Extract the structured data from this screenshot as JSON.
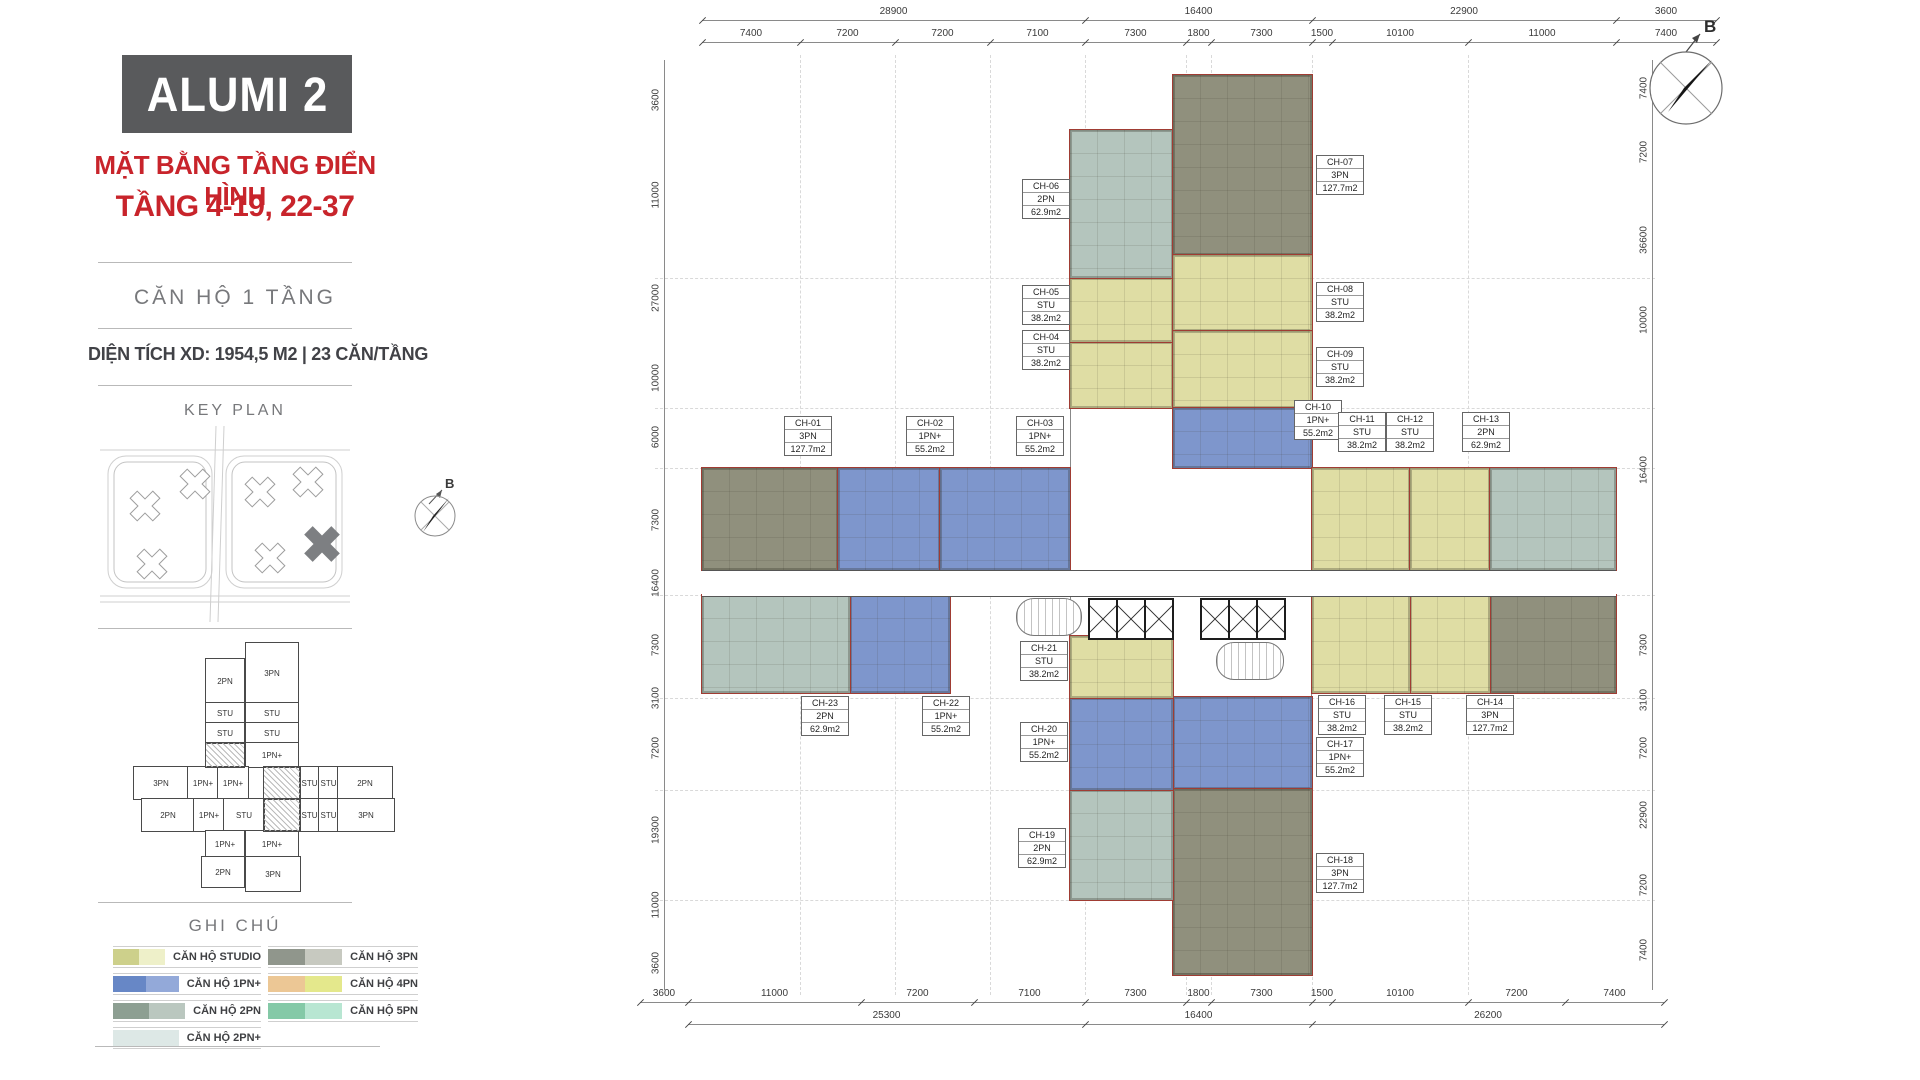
{
  "colors": {
    "accent_red": "#c8242b",
    "header_bg": "#595a5c",
    "unit_studio": "#dfdda4",
    "unit_1pn_plus": "#7e96cc",
    "unit_2pn": "#b4c5bd",
    "unit_3pn": "#90907d",
    "boundary_red": "#a03c33"
  },
  "sidebar": {
    "title": "ALUMI 2",
    "subtitle_line1": "MẶT BẰNG TẦNG ĐIỂN HÌNH",
    "subtitle_line2": "TẦNG 4-19, 22-37",
    "section_label": "CĂN HỘ 1 TẦNG",
    "stats_line": "DIỆN TÍCH XD: 1954,5 M2  |  23 CĂN/TẦNG",
    "key_plan_title": "KEY PLAN",
    "legend_title": "GHI CHÚ",
    "legend_left": [
      {
        "label": "CĂN HỘ STUDIO",
        "c1": "#cdd08b",
        "c2": "#eef0c9"
      },
      {
        "label": "CĂN HỘ 1PN+",
        "c1": "#6787c6",
        "c2": "#93a9d9"
      },
      {
        "label": "CĂN HỘ 2PN",
        "c1": "#8d9f92",
        "c2": "#bac7bf"
      },
      {
        "label": "CĂN HỘ 2PN+",
        "c1": "#dde8e6",
        "c2": "#dde8e6"
      }
    ],
    "legend_right": [
      {
        "label": "CĂN HỘ 3PN",
        "c1": "#90968c",
        "c2": "#c7c9c0"
      },
      {
        "label": "CĂN HỘ 4PN",
        "c1": "#ecc795",
        "c2": "#e4e88c"
      },
      {
        "label": "CĂN HỘ 5PN",
        "c1": "#84c9a7",
        "c2": "#b8e6d2"
      }
    ],
    "mini_plan_labels": [
      "2PN",
      "3PN",
      "STU",
      "STU",
      "STU",
      "STU",
      "1PN+",
      "3PN",
      "1PN+",
      "1PN+",
      "STU",
      "STU",
      "2PN",
      "2PN",
      "1PN+",
      "STU",
      "STU",
      "STU",
      "3PN",
      "1PN+",
      "1PN+",
      "2PN",
      "3PN"
    ]
  },
  "plan": {
    "compass_label": "B",
    "units": [
      {
        "id": "CH-01",
        "type": "3PN",
        "area": "127.7m2",
        "color": "3pn"
      },
      {
        "id": "CH-02",
        "type": "1PN+",
        "area": "55.2m2",
        "color": "1pn"
      },
      {
        "id": "CH-03",
        "type": "1PN+",
        "area": "55.2m2",
        "color": "1pn"
      },
      {
        "id": "CH-04",
        "type": "STU",
        "area": "38.2m2",
        "color": "stu"
      },
      {
        "id": "CH-05",
        "type": "STU",
        "area": "38.2m2",
        "color": "stu"
      },
      {
        "id": "CH-06",
        "type": "2PN",
        "area": "62.9m2",
        "color": "2pn"
      },
      {
        "id": "CH-07",
        "type": "3PN",
        "area": "127.7m2",
        "color": "3pn"
      },
      {
        "id": "CH-08",
        "type": "STU",
        "area": "38.2m2",
        "color": "stu"
      },
      {
        "id": "CH-09",
        "type": "STU",
        "area": "38.2m2",
        "color": "stu"
      },
      {
        "id": "CH-10",
        "type": "1PN+",
        "area": "55.2m2",
        "color": "1pn"
      },
      {
        "id": "CH-11",
        "type": "STU",
        "area": "38.2m2",
        "color": "stu"
      },
      {
        "id": "CH-12",
        "type": "STU",
        "area": "38.2m2",
        "color": "stu"
      },
      {
        "id": "CH-13",
        "type": "2PN",
        "area": "62.9m2",
        "color": "2pn"
      },
      {
        "id": "CH-14",
        "type": "3PN",
        "area": "127.7m2",
        "color": "3pn"
      },
      {
        "id": "CH-15",
        "type": "STU",
        "area": "38.2m2",
        "color": "stu"
      },
      {
        "id": "CH-16",
        "type": "STU",
        "area": "38.2m2",
        "color": "stu"
      },
      {
        "id": "CH-17",
        "type": "1PN+",
        "area": "55.2m2",
        "color": "1pn"
      },
      {
        "id": "CH-18",
        "type": "3PN",
        "area": "127.7m2",
        "color": "3pn"
      },
      {
        "id": "CH-19",
        "type": "2PN",
        "area": "62.9m2",
        "color": "2pn"
      },
      {
        "id": "CH-20",
        "type": "1PN+",
        "area": "55.2m2",
        "color": "1pn"
      },
      {
        "id": "CH-21",
        "type": "STU",
        "area": "38.2m2",
        "color": "stu"
      },
      {
        "id": "CH-22",
        "type": "1PN+",
        "area": "55.2m2",
        "color": "1pn"
      },
      {
        "id": "CH-23",
        "type": "2PN",
        "area": "62.9m2",
        "color": "2pn"
      }
    ],
    "dimensions": {
      "top_totals": [
        "28900",
        "16400",
        "22900",
        "3600"
      ],
      "top_segments": [
        "7400",
        "7200",
        "7200",
        "7100",
        "7300",
        "1800",
        "7300",
        "1500",
        "10100",
        "11000",
        "7400"
      ],
      "bottom_segments": [
        "3600",
        "11000",
        "7200",
        "7100",
        "7300",
        "1800",
        "7300",
        "1500",
        "10100",
        "7200",
        "7400"
      ],
      "bottom_totals": [
        "25300",
        "16400",
        "26200"
      ],
      "left": [
        "3600",
        "11000",
        "27000",
        "10000",
        "6000",
        "7300",
        "16400",
        "7300",
        "3100",
        "7200",
        "19300",
        "11000",
        "3600"
      ],
      "right": [
        "7400",
        "7200",
        "36600",
        "10000",
        "16400",
        "7300",
        "3100",
        "7200",
        "22900",
        "7200",
        "7400"
      ]
    }
  }
}
